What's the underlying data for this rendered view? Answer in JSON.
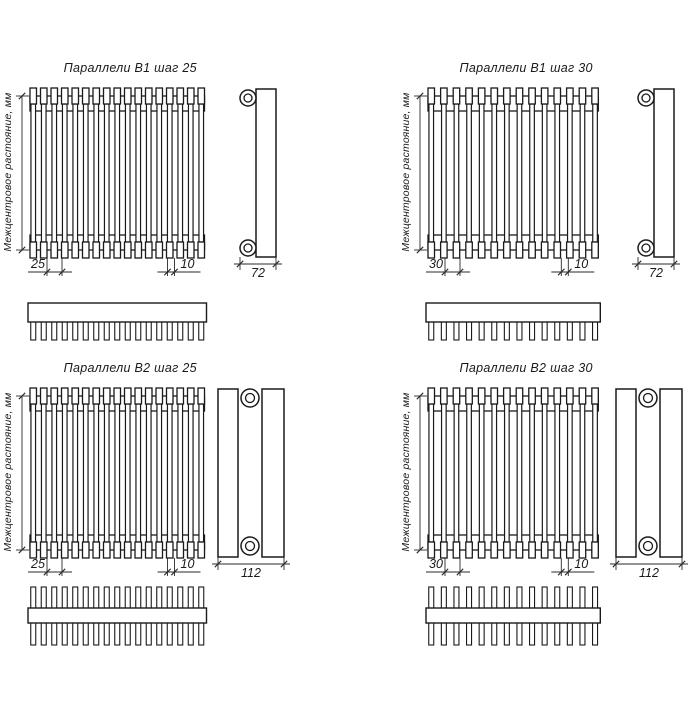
{
  "canvas": {
    "background": "#ffffff",
    "line_color": "#1a1a1a",
    "dim_line_color": "#2a2a2a"
  },
  "axis_label": "Межцентровое растояние, мм",
  "drawings": [
    {
      "title": "Параллели В1 шаг 25",
      "variant": "B1",
      "step_mm": 25,
      "tube_count": 17,
      "comb_teeth": 17,
      "labels": {
        "step": "25",
        "tube": "10",
        "depth": "72"
      }
    },
    {
      "title": "Параллели В1 шаг 30",
      "variant": "B1",
      "step_mm": 30,
      "tube_count": 14,
      "comb_teeth": 14,
      "labels": {
        "step": "30",
        "tube": "10",
        "depth": "72"
      }
    },
    {
      "title": "Параллели В2 шаг 25",
      "variant": "B2",
      "step_mm": 25,
      "tube_count": 17,
      "comb_teeth": 17,
      "labels": {
        "step": "25",
        "tube": "10",
        "depth": "112"
      }
    },
    {
      "title": "Параллели В2 шаг 30",
      "variant": "B2",
      "step_mm": 30,
      "tube_count": 14,
      "comb_teeth": 14,
      "labels": {
        "step": "30",
        "tube": "10",
        "depth": "112"
      }
    }
  ]
}
